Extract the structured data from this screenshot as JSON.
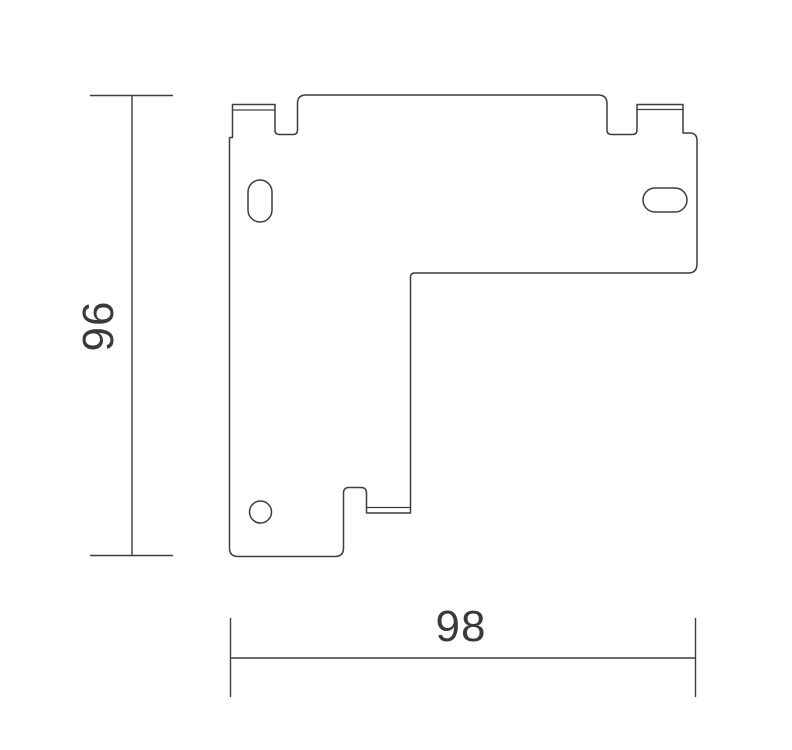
{
  "page": {
    "background_color": "#ffffff",
    "line_color": "#3d3d3d",
    "text_color": "#3a3a3a"
  },
  "drawing": {
    "dimensions": {
      "height_label": "96",
      "width_label": "98"
    }
  }
}
